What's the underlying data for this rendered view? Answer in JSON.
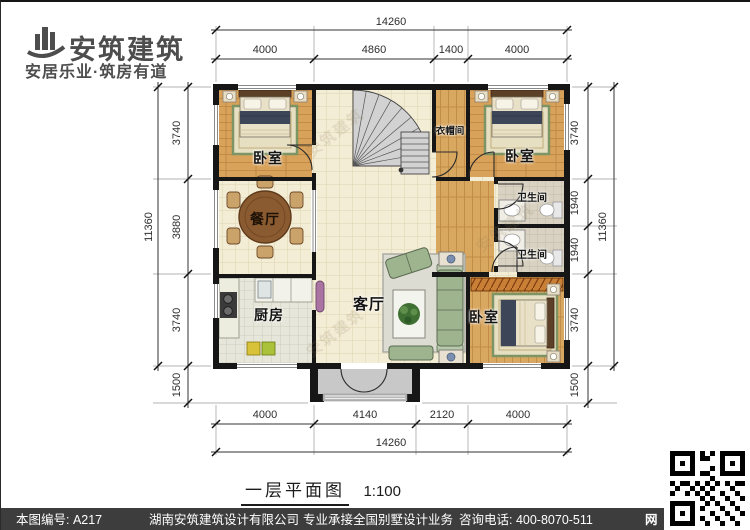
{
  "brand": {
    "name": "安筑建筑",
    "tagline": "安居乐业·筑房有道"
  },
  "plan": {
    "rooms": {
      "bedroom_tl": "卧室",
      "dining": "餐厅",
      "kitchen": "厨房",
      "living": "客厅",
      "closet": "衣帽间",
      "bedroom_tr": "卧室",
      "bath_upper": "卫生间",
      "bath_lower": "卫生间",
      "bedroom_br": "卧室"
    },
    "watermark": "安筑建筑"
  },
  "dims": {
    "top": {
      "overall": "14260",
      "segments": [
        "4000",
        "4860",
        "1400",
        "4000"
      ]
    },
    "bottom": {
      "overall": "14260",
      "segments": [
        "4000",
        "4140",
        "2120",
        "4000"
      ]
    },
    "left": {
      "overall": "11360",
      "segments": [
        "3740",
        "3880",
        "3740",
        "1500"
      ]
    },
    "right": {
      "overall": "11360",
      "segments": [
        "3740",
        "1940",
        "1940",
        "3740",
        "1500"
      ]
    }
  },
  "title": {
    "name": "一层平面图",
    "scale": "1:100"
  },
  "footer": {
    "sheet_no": "本图编号: A217",
    "company": "湖南安筑建筑设计有限公司",
    "service": "专业承接全国别墅设计业务",
    "phone": "咨询电话: 400-8070-511",
    "web": "网"
  },
  "colors": {
    "wall": "#1a1a1a",
    "wood_floor": "#d9a25a",
    "tile_floor": "#f4edd6",
    "footer_bar": "#3d3d3d"
  }
}
